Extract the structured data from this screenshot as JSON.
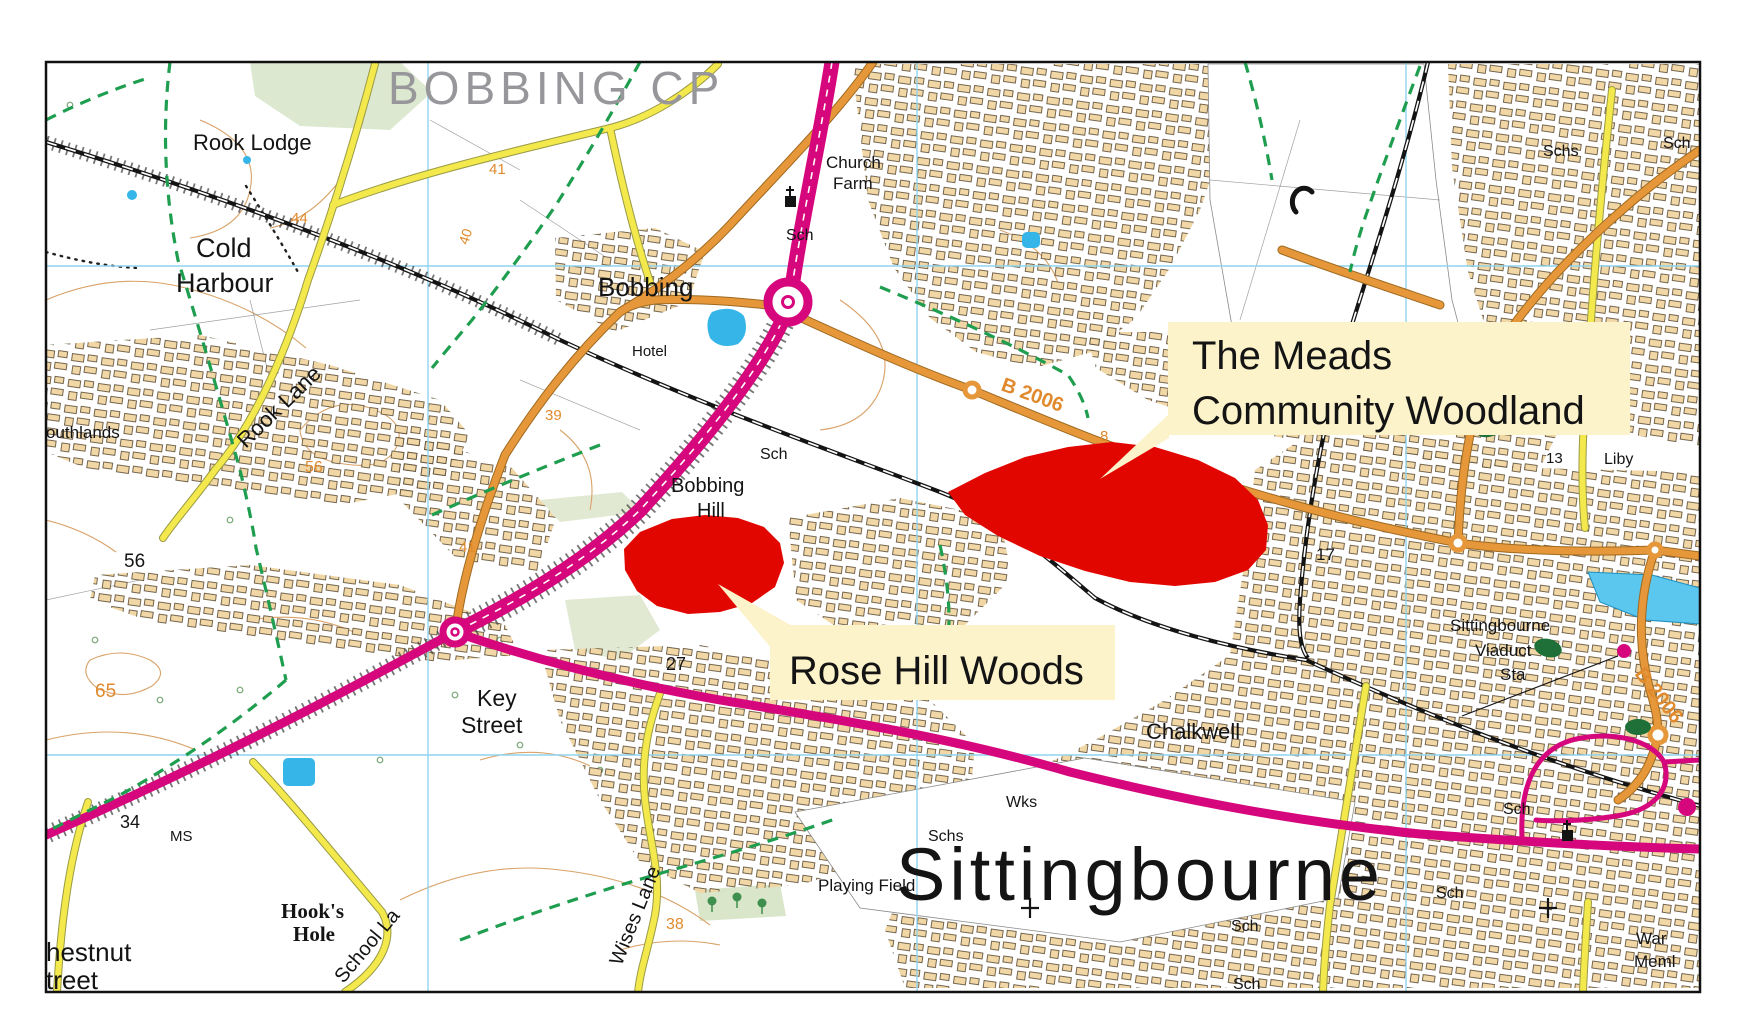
{
  "map": {
    "parish": "BOBBING CP",
    "town": "Sittingbourne",
    "callouts": {
      "meads_line1": "The Meads",
      "meads_line2": "Community Woodland",
      "rosehill": "Rose Hill Woods"
    },
    "places": {
      "rook_lodge": "Rook Lodge",
      "cold_harbour_l1": "Cold",
      "cold_harbour_l2": "Harbour",
      "bobbing": "Bobbing",
      "hotel": "Hotel",
      "church_farm_l1": "Church",
      "church_farm_l2": "Farm",
      "bobbing_hill_l1": "Bobbing",
      "bobbing_hill_l2": "Hill",
      "key_street_l1": "Key",
      "key_street_l2": "Street",
      "southlands_clipped": "outhlands",
      "chestnut_l1": "hestnut",
      "chestnut_l2": "treet",
      "hooks_hole_l1": "Hook's",
      "hooks_hole_l2": "Hole",
      "chalkwell": "Chalkwell",
      "playing_field": "Playing Field",
      "wks": "Wks",
      "ms": "MS",
      "liby": "Liby",
      "war_meml_l1": "War",
      "war_meml_l2": "Meml",
      "viaduct_l1": "Sittingbourne",
      "viaduct_l2": "Viaduct",
      "viaduct_l3": "Sta",
      "sch": "Sch",
      "schs": "Schs"
    },
    "roads": {
      "rook_lane": "Rook Lane",
      "school_lane": "School La",
      "wises_lane": "Wises Lane",
      "b2006": "B 2006"
    },
    "numbers": {
      "n41": "41",
      "n44": "44",
      "n40": "40",
      "n39": "39",
      "n56": "56",
      "n65": "65",
      "n27": "27",
      "n34": "34",
      "n38": "38",
      "n17": "17",
      "n13": "13",
      "n8": "8"
    },
    "colors": {
      "highlight": "#e10600",
      "primary_road": "#d6077c",
      "b_road": "#e5973a",
      "minor_road": "#f3e94c",
      "callout_bg": "#fcf3cb",
      "grid": "#8fd4ef",
      "contour": "#d9a268",
      "footpath": "#1f9e50",
      "water": "#35b5e8",
      "parish_text": "#97979b"
    }
  }
}
